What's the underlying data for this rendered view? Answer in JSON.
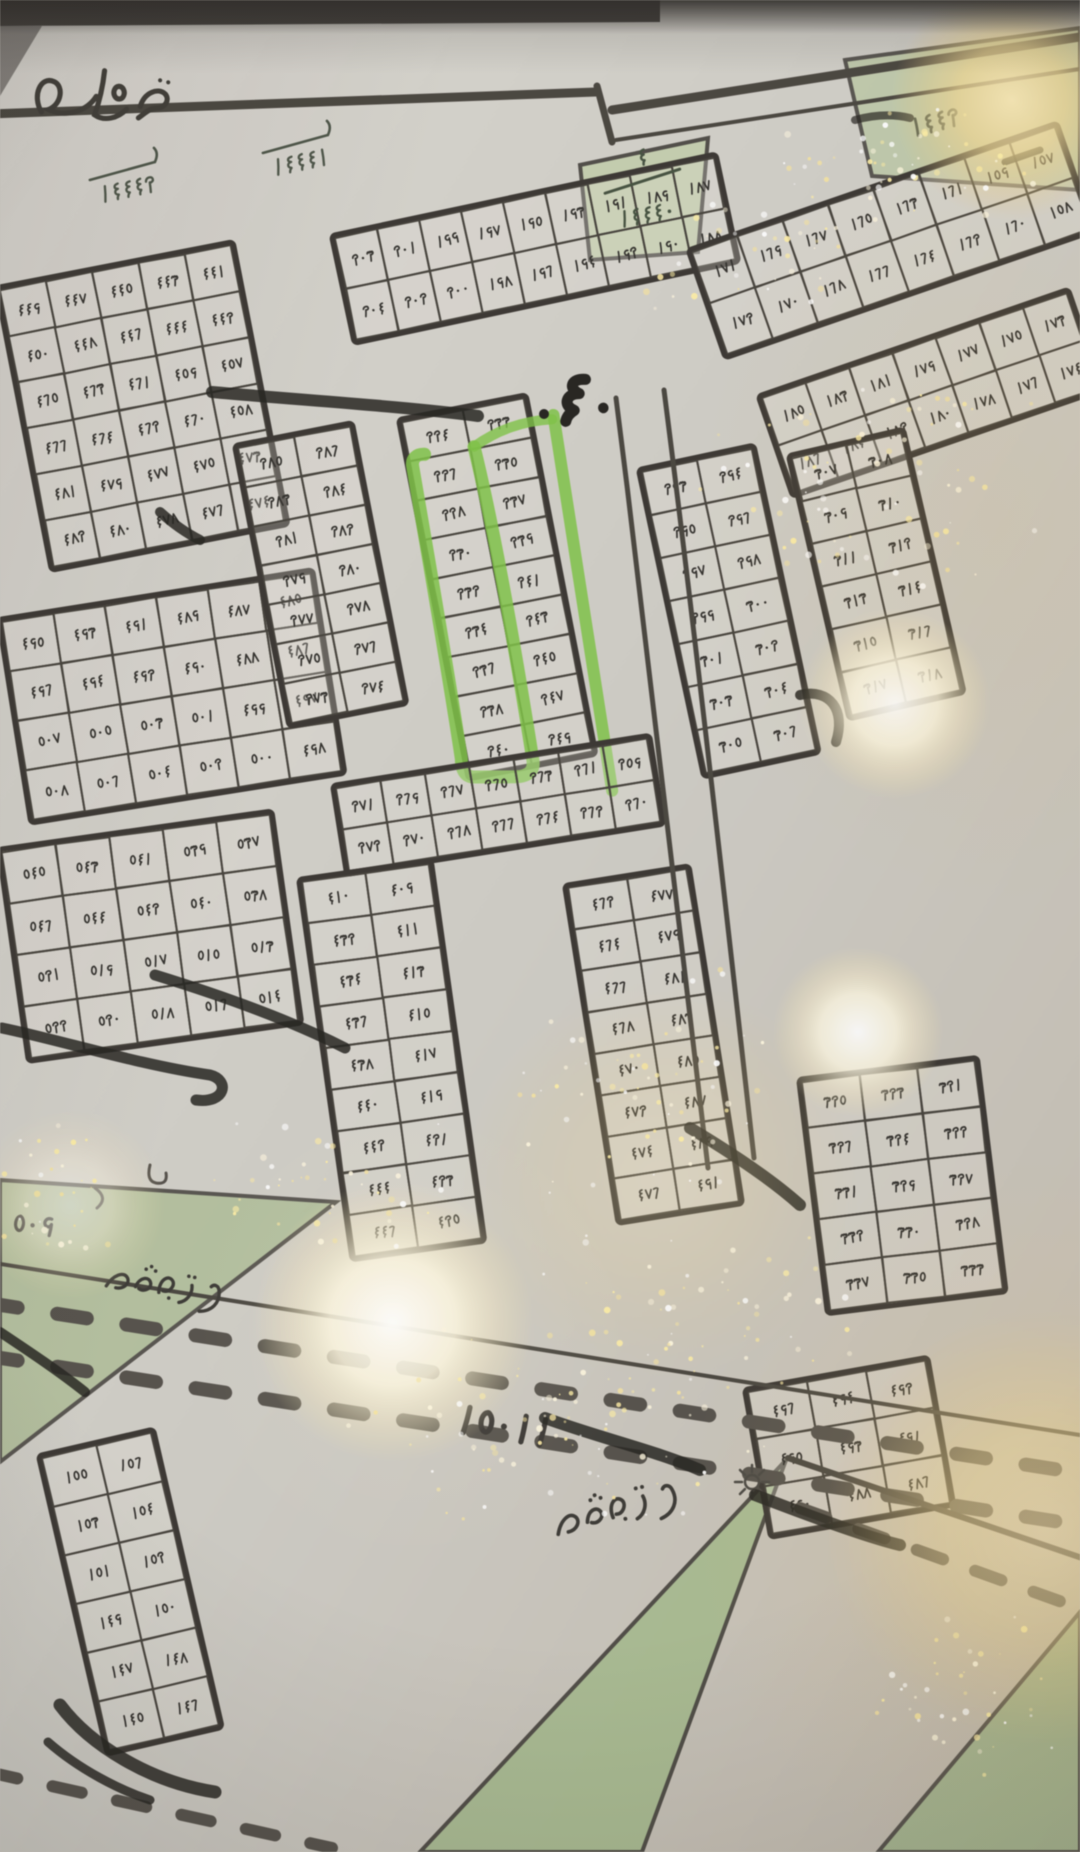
{
  "colors": {
    "paper": "#cfccc5",
    "ink": "#47433c",
    "digit_ink": "#33312d",
    "marker_black": "#262420",
    "park_green": "#adbd93",
    "highlight_green": "#7cc63f",
    "glare_warm": "#f2d88f"
  },
  "top": {
    "road_label": "طريق"
  },
  "landmarks": {
    "street_width_marker": "٤٠",
    "bottom_plan_number": "١٥٠١١",
    "left_edge_number": "٥٠٩"
  },
  "named_blocks": [
    {
      "id": "tl-1",
      "number": "١٤٤٤٢"
    },
    {
      "id": "tl-2",
      "number": "١٤٤٤١"
    },
    {
      "id": "top-triangle",
      "numerator": "٤",
      "number": "١٤٤٤٠"
    },
    {
      "id": "top-right-triangle",
      "number": "١٤٤٢"
    }
  ],
  "parks": [
    {
      "id": "park-left",
      "label": "تشجير"
    },
    {
      "id": "park-bottom",
      "label": "تشجير"
    }
  ],
  "highlight": {
    "color": "#7cc63f",
    "plots": [
      "٢٢٦",
      "٢٢٨",
      "٢٣٠",
      "٢٣٢",
      "٢٣٤",
      "٢٣٦",
      "٢٣٨",
      "٢٤٠"
    ]
  },
  "blocks": [
    {
      "id": "g",
      "rows": [
        [
          "٤٤٩",
          "٤٤٧",
          "٤٤٥",
          "٤٤٣",
          "٤٤١"
        ],
        [
          "٤٥٠",
          "٤٤٨",
          "٤٤٦",
          "٤٤٤",
          "٤٤٢"
        ],
        [
          "٤٦٥",
          "٤٦٣",
          "٤٦١",
          "٤٥٩",
          "٤٥٧"
        ],
        [
          "٤٦٦",
          "٤٦٤",
          "٤٦٢",
          "٤٦٠",
          "٤٥٨"
        ],
        [
          "٤٨١",
          "٤٧٩",
          "٤٧٧",
          "٤٧٥",
          "٤٧٣"
        ],
        [
          "٤٨٢",
          "٤٨٠",
          "٤٧٨",
          "٤٧٦",
          "٤٧٤"
        ]
      ]
    },
    {
      "id": "h",
      "rows": [
        [
          "٤٩٥",
          "٤٩٣",
          "٤٩١",
          "٤٨٩",
          "٤٨٧",
          "٤٨٥"
        ],
        [
          "٤٩٦",
          "٤٩٤",
          "٤٩٢",
          "٤٩٠",
          "٤٨٨",
          "٤٨٦"
        ],
        [
          "٥٠٧",
          "٥٠٥",
          "٥٠٣",
          "٥٠١",
          "٤٩٩",
          "٤٩٧"
        ],
        [
          "٥٠٨",
          "٥٠٦",
          "٥٠٤",
          "٥٠٢",
          "٥٠٠",
          "٤٩٨"
        ]
      ]
    },
    {
      "id": "h2",
      "rows": [
        [
          "٥٤٥",
          "٥٤٣",
          "٥٤١",
          "٥٣٩",
          "٥٣٧"
        ],
        [
          "٥٤٦",
          "٥٤٤",
          "٥٤٢",
          "٥٤٠",
          "٥٣٨"
        ],
        [
          "٥٢١",
          "٥١٩",
          "٥١٧",
          "٥١٥",
          "٥١٣"
        ],
        [
          "٥٢٢",
          "٥٢٠",
          "٥١٨",
          "٥١٦",
          "٥١٤"
        ]
      ]
    },
    {
      "id": "e",
      "rows": [
        [
          "٢٠٣",
          "٢٠١",
          "١٩٩",
          "١٩٧",
          "١٩٥",
          "١٩٣",
          "١٩١",
          "١٨٩",
          "١٨٧"
        ],
        [
          "٢٠٤",
          "٢٠٢",
          "٢٠٠",
          "١٩٨",
          "١٩٦",
          "١٩٤",
          "١٩٢",
          "١٩٠",
          "١٨٨"
        ]
      ]
    },
    {
      "id": "d",
      "rows": [
        [
          "١٧١",
          "١٦٩",
          "١٦٧",
          "١٦٥",
          "١٦٣",
          "١٦١",
          "١٥٩",
          "١٥٧"
        ],
        [
          "١٧٢",
          "١٧٠",
          "١٦٨",
          "١٦٦",
          "١٦٤",
          "١٦٢",
          "١٦٠",
          "١٥٨"
        ]
      ]
    },
    {
      "id": "f",
      "rows": [
        [
          "١٨٥",
          "١٨٣",
          "١٨١",
          "١٧٩",
          "١٧٧",
          "١٧٥",
          "١٧٣"
        ],
        [
          "١٨٦",
          "١٨٤",
          "١٨٢",
          "١٨٠",
          "١٧٨",
          "١٧٦",
          "١٧٤"
        ]
      ]
    },
    {
      "id": "i0",
      "rows": [
        [
          "٢٨٥",
          "٢٨٦"
        ],
        [
          "٢٨٣",
          "٢٨٤"
        ],
        [
          "٢٨١",
          "٢٨٢"
        ],
        [
          "٢٧٩",
          "٢٨٠"
        ],
        [
          "٢٧٧",
          "٢٧٨"
        ],
        [
          "٢٧٥",
          "٢٧٦"
        ],
        [
          "٢٧٣",
          "٢٧٤"
        ]
      ]
    },
    {
      "id": "i",
      "rows": [
        [
          "٢٢٤",
          "٢٣٣"
        ],
        [
          "٢٢٦",
          "٢٣٥"
        ],
        [
          "٢٢٨",
          "٢٣٧"
        ],
        [
          "٢٣٠",
          "٢٣٩"
        ],
        [
          "٢٣٢",
          "٢٤١"
        ],
        [
          "٢٣٤",
          "٢٤٣"
        ],
        [
          "٢٣٦",
          "٢٤٥"
        ],
        [
          "٢٣٨",
          "٢٤٧"
        ],
        [
          "٢٤٠",
          "٢٤٩"
        ]
      ]
    },
    {
      "id": "j",
      "rows": [
        [
          "٢٩٣",
          "٢٩٤"
        ],
        [
          "٢٩٥",
          "٢٩٦"
        ],
        [
          "٢٩٧",
          "٢٩٨"
        ],
        [
          "٢٩٩",
          "٣٠٠"
        ],
        [
          "٣٠١",
          "٣٠٢"
        ],
        [
          "٣٠٣",
          "٣٠٤"
        ],
        [
          "٣٠٥",
          "٣٠٦"
        ]
      ]
    },
    {
      "id": "j2",
      "rows": [
        [
          "٣٠٧",
          "٣٠٨"
        ],
        [
          "٣٠٩",
          "٣١٠"
        ],
        [
          "٣١١",
          "٣١٢"
        ],
        [
          "٣١٣",
          "٣١٤"
        ],
        [
          "٣١٥",
          "٣١٦"
        ],
        [
          "٣١٧",
          "٣١٨"
        ]
      ]
    },
    {
      "id": "k",
      "rows": [
        [
          "٢٧١",
          "٢٦٩",
          "٢٦٧",
          "٢٦٥",
          "٢٦٣",
          "٢٦١",
          "٢٥٩"
        ],
        [
          "٢٧٢",
          "٢٧٠",
          "٢٦٨",
          "٢٦٦",
          "٢٦٤",
          "٢٦٢",
          "٢٦٠"
        ]
      ]
    },
    {
      "id": "l",
      "rows": [
        [
          "٤١٠",
          "٤٠٩"
        ],
        [
          "٤٣٢",
          "٤١١"
        ],
        [
          "٤٣٤",
          "٤١٣"
        ],
        [
          "٤٣٦",
          "٤١٥"
        ],
        [
          "٤٣٨",
          "٤١٧"
        ],
        [
          "٤٤٠",
          "٤١٩"
        ],
        [
          "٤٤٢",
          "٤٢١"
        ],
        [
          "٤٤٤",
          "٤٢٣"
        ],
        [
          "٤٤٦",
          "٤٢٥"
        ]
      ]
    },
    {
      "id": "m",
      "rows": [
        [
          "٤٦٢",
          "٤٧٧"
        ],
        [
          "٤٦٤",
          "٤٧٩"
        ],
        [
          "٤٦٦",
          "٤٨١"
        ],
        [
          "٤٦٨",
          "٤٨٣"
        ],
        [
          "٤٧٠",
          "٤٨٥"
        ],
        [
          "٤٧٢",
          "٤٨٧"
        ],
        [
          "٤٧٤",
          "٤٨٩"
        ],
        [
          "٤٧٦",
          "٤٩١"
        ]
      ]
    },
    {
      "id": "n",
      "rows": [
        [
          "٣٢٥",
          "٣٢٣",
          "٣٢١"
        ],
        [
          "٣٢٦",
          "٣٢٤",
          "٣٢٢"
        ],
        [
          "٣٣١",
          "٣٢٩",
          "٣٢٧"
        ],
        [
          "٣٣٢",
          "٣٣٠",
          "٣٢٨"
        ],
        [
          "٣٣٧",
          "٣٣٥",
          "٣٣٣"
        ]
      ]
    },
    {
      "id": "p",
      "rows": [
        [
          "٤٩٦",
          "٤٩٤",
          "٤٩٢"
        ],
        [
          "٤٩٥",
          "٤٩٣",
          "٤٩١"
        ],
        [
          "٤٩٠",
          "٤٨٨",
          "٤٨٦"
        ]
      ]
    },
    {
      "id": "q",
      "rows": [
        [
          "١٥٥",
          "١٥٦"
        ],
        [
          "١٥٣",
          "١٥٤"
        ],
        [
          "١٥١",
          "١٥٢"
        ],
        [
          "١٤٩",
          "١٥٠"
        ],
        [
          "١٤٧",
          "١٤٨"
        ],
        [
          "١٤٥",
          "١٤٦"
        ]
      ]
    }
  ]
}
